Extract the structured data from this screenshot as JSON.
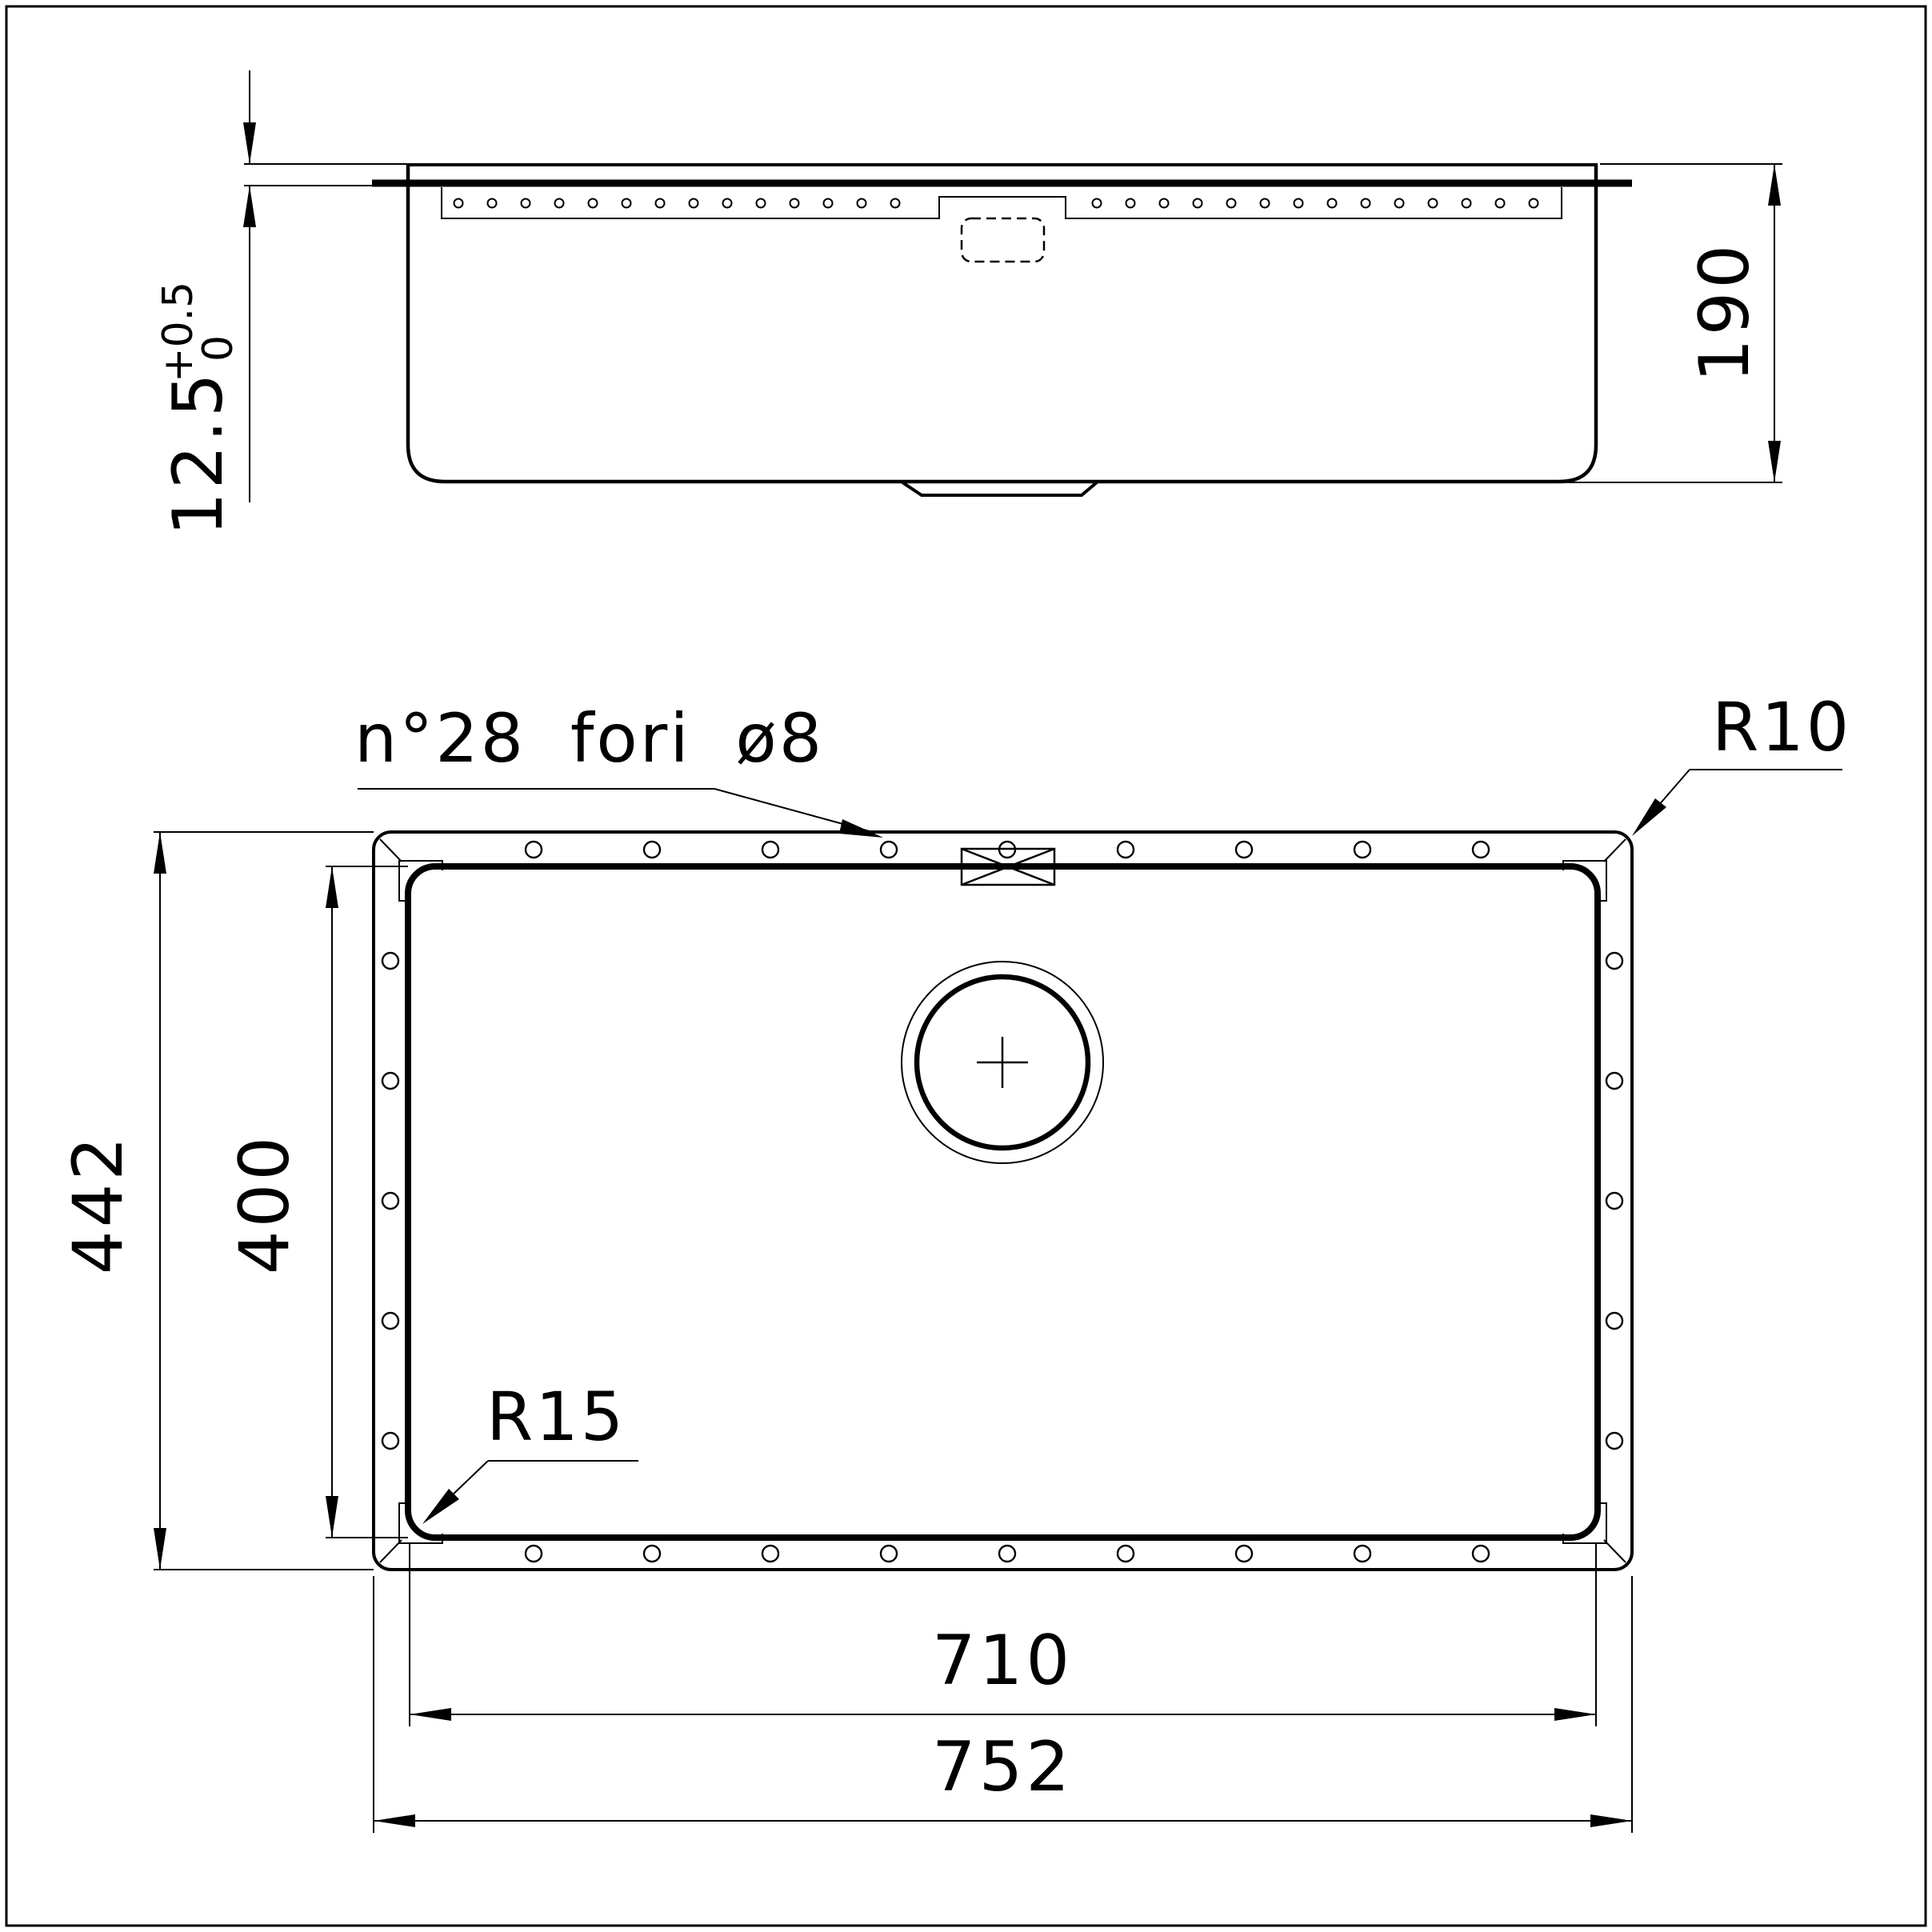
{
  "page": {
    "background_color": "#ffffff",
    "line_color": "#000000",
    "description": "Technical drawing of undermount sink: front section view and plan view with dimensions"
  },
  "side_view": {
    "dim_rim_thickness": {
      "value": "12.5",
      "tol_upper": "+0.5",
      "tol_lower": "0"
    },
    "dim_depth": {
      "value": "190"
    }
  },
  "plan_view": {
    "note_holes": {
      "text": "n°28 fori ø8"
    },
    "label_radius_rim": {
      "text": "R10"
    },
    "label_radius_bowl": {
      "text": "R15"
    },
    "dim_rim_height": {
      "value": "442"
    },
    "dim_bowl_height": {
      "value": "400"
    },
    "dim_bowl_width": {
      "value": "710"
    },
    "dim_rim_width": {
      "value": "752"
    }
  }
}
